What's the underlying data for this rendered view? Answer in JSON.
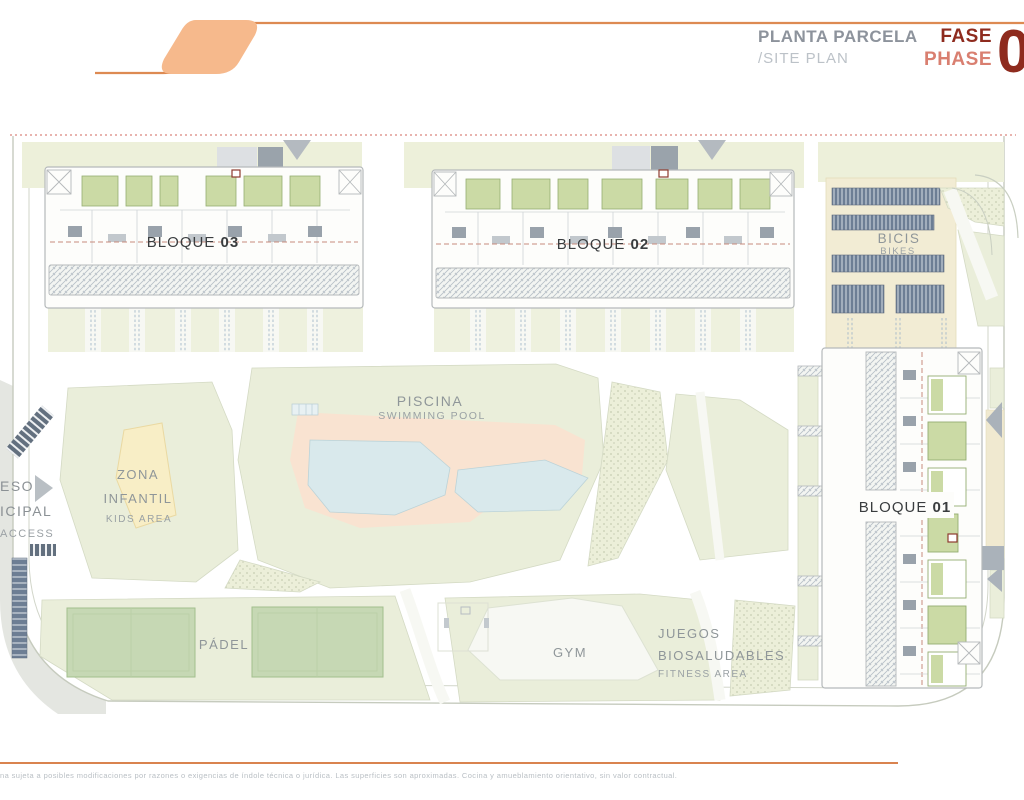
{
  "header": {
    "title_primary": "PLANTA PARCELA",
    "title_secondary": "/SITE PLAN",
    "phase_label_es": "FASE",
    "phase_label_en": "PHASE",
    "phase_number": "0"
  },
  "plan": {
    "blocks": [
      {
        "name": "BLOQUE",
        "number": "03"
      },
      {
        "name": "BLOQUE",
        "number": "02"
      },
      {
        "name": "BLOQUE",
        "number": "01"
      }
    ],
    "labels": {
      "pool_es": "PISCINA",
      "pool_en": "SWIMMING POOL",
      "kids_es1": "ZONA",
      "kids_es2": "INFANTIL",
      "kids_en": "KIDS AREA",
      "padel": "PÁDEL",
      "gym": "GYM",
      "fitness_es1": "JUEGOS",
      "fitness_es2": "BIOSALUDABLES",
      "fitness_en": "FITNESS AREA",
      "bikes_es": "BICIS",
      "bikes_en": "BIKES",
      "access_line1": "ESO",
      "access_line2": "ICIPAL",
      "access_line3": "ACCESS"
    }
  },
  "footer": {
    "disclaimer": "na sujeta a posibles modificaciones por razones o exigencias de índole técnica o jurídica. Las superficies son aproximadas. Cocina y amueblamiento orientativo, sin valor contractual."
  },
  "colors": {
    "accent_orange": "#e78a4e",
    "logo_fill": "#f6b98c",
    "brand_dark_red": "#8e2b1e",
    "brand_salmon": "#d97f70",
    "lawn_green": "#eaeeda",
    "pool_blue": "#d9e9ec",
    "deck_peach": "#f9e3d1",
    "court_green": "#c6d8b4",
    "parking_beige": "#f2ecd4",
    "rack_slate": "#6d7e94"
  }
}
